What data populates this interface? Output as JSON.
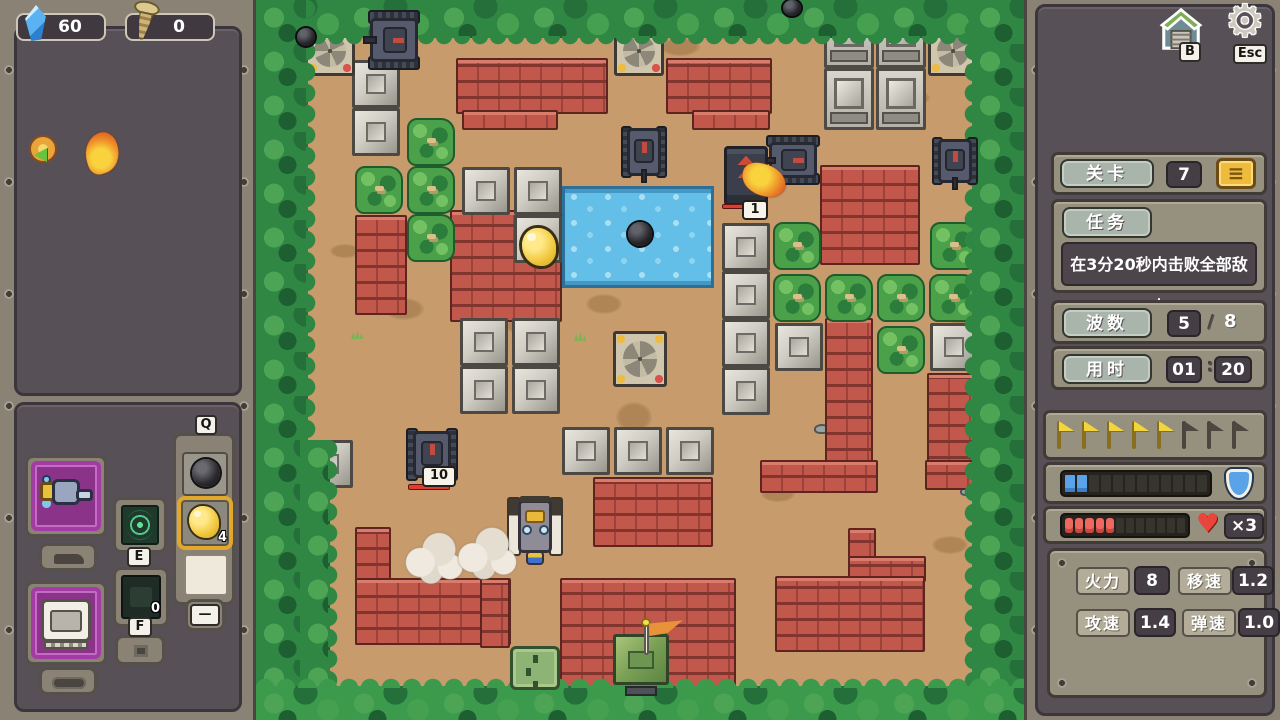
{
  "colors": {
    "accent_gold": "#eebb3d",
    "hp_red": "#ef6860",
    "shield_blue": "#5ba3e8",
    "brick": "#c2574b",
    "panel_dark": "#575056",
    "panel_frame": "#8a8375"
  },
  "left_panel": {
    "resources": [
      {
        "name": "crystal",
        "icon": "crystal-icon",
        "value": "60"
      },
      {
        "name": "screw",
        "icon": "screw-icon",
        "value": "0"
      }
    ],
    "buffs": [
      {
        "name": "return-arrow-buff"
      },
      {
        "name": "flame-buff"
      }
    ],
    "loadout": {
      "q_key": "Q",
      "e_key": "E",
      "f_key": "F",
      "f_count": "0",
      "gold_count": "4",
      "dash": "—",
      "weapon_slot": {
        "name": "cannon"
      },
      "hull_slot": {
        "name": "hull"
      },
      "q_items": [
        {
          "name": "bomb"
        },
        {
          "name": "gold",
          "count": "4",
          "selected": true
        },
        {
          "name": "empty"
        }
      ]
    }
  },
  "right_panel": {
    "garage_key": "B",
    "settings_key": "Esc",
    "level": {
      "label": "关卡",
      "value": "7",
      "button_glyph": "≡"
    },
    "mission": {
      "label": "任务",
      "text": "在3分20秒内击败全部敌人"
    },
    "wave": {
      "label": "波数",
      "current": "5",
      "separator": "/",
      "total": "8"
    },
    "time": {
      "label": "用时",
      "minutes": "01",
      "colon": ":",
      "seconds": "20"
    },
    "wave_flags": {
      "total": 8,
      "lit": 5
    },
    "shield_bar": {
      "segments": 12,
      "filled": 2
    },
    "hp_bar": {
      "segments": 12,
      "filled": 5,
      "lives_label": "×3"
    },
    "stats": [
      {
        "label": "火力",
        "value": "8"
      },
      {
        "label": "移速",
        "value": "1.2"
      },
      {
        "label": "攻速",
        "value": "1.4"
      },
      {
        "label": "弹速",
        "value": "1.0"
      }
    ]
  },
  "map": {
    "entities": [
      {
        "t": "spot",
        "x": 404,
        "y": 38,
        "w": 40,
        "h": 18
      },
      {
        "t": "spot",
        "x": 448,
        "y": 26,
        "w": 30,
        "h": 14
      },
      {
        "t": "spot",
        "x": 128,
        "y": 298,
        "w": 40,
        "h": 22
      },
      {
        "t": "spot",
        "x": 330,
        "y": 294,
        "w": 36,
        "h": 20
      },
      {
        "t": "spot",
        "x": 288,
        "y": 650,
        "w": 40,
        "h": 18
      },
      {
        "t": "spot",
        "x": 505,
        "y": 486,
        "w": 34,
        "h": 16
      },
      {
        "t": "spot",
        "x": 640,
        "y": 90,
        "w": 34,
        "h": 16
      },
      {
        "t": "spot",
        "x": 694,
        "y": 296,
        "w": 30,
        "h": 40
      },
      {
        "t": "spot",
        "x": 404,
        "y": 586,
        "w": 40,
        "h": 20
      },
      {
        "t": "spot",
        "x": 74,
        "y": 244,
        "w": 30,
        "h": 14
      },
      {
        "t": "spot",
        "x": 676,
        "y": 536,
        "w": 36,
        "h": 18
      },
      {
        "t": "spot",
        "x": 310,
        "y": 653,
        "w": 50,
        "h": 22
      },
      {
        "t": "spot",
        "x": 360,
        "y": 402,
        "w": 36,
        "h": 30
      },
      {
        "t": "spot",
        "x": 250,
        "y": 318,
        "w": 30,
        "h": 16
      },
      {
        "t": "pebble",
        "x": 558,
        "y": 424,
        "w": 16,
        "h": 10
      },
      {
        "t": "pebble",
        "x": 704,
        "y": 487,
        "w": 14,
        "h": 9
      },
      {
        "t": "pebble",
        "x": 178,
        "y": 612,
        "w": 18,
        "h": 10
      },
      {
        "t": "pebble",
        "x": 238,
        "y": 604,
        "w": 16,
        "h": 9
      },
      {
        "t": "pebble",
        "x": 310,
        "y": 250,
        "w": 15,
        "h": 9
      },
      {
        "t": "grass",
        "x": 95,
        "y": 330,
        "w": 12,
        "h": 9
      },
      {
        "t": "grass",
        "x": 318,
        "y": 332,
        "w": 12,
        "h": 9
      },
      {
        "t": "grass",
        "x": 60,
        "y": 624,
        "w": 12,
        "h": 9
      },
      {
        "t": "grass",
        "x": 520,
        "y": 610,
        "w": 12,
        "h": 9
      },
      {
        "t": "water",
        "x": 306,
        "y": 186,
        "w": 152,
        "h": 102
      },
      {
        "t": "brick",
        "x": 200,
        "y": 58,
        "w": 152,
        "h": 56
      },
      {
        "t": "brick",
        "x": 206,
        "y": 110,
        "w": 96,
        "h": 20
      },
      {
        "t": "brick",
        "x": 410,
        "y": 58,
        "w": 106,
        "h": 56
      },
      {
        "t": "brick",
        "x": 436,
        "y": 110,
        "w": 78,
        "h": 20
      },
      {
        "t": "brick",
        "x": 99,
        "y": 215,
        "w": 52,
        "h": 100
      },
      {
        "t": "brick",
        "x": 194,
        "y": 210,
        "w": 112,
        "h": 112
      },
      {
        "t": "brick",
        "x": 564,
        "y": 165,
        "w": 100,
        "h": 100
      },
      {
        "t": "brick",
        "x": 569,
        "y": 318,
        "w": 48,
        "h": 148
      },
      {
        "t": "brick",
        "x": 671,
        "y": 373,
        "w": 48,
        "h": 117
      },
      {
        "t": "brick",
        "x": 504,
        "y": 460,
        "w": 118,
        "h": 33
      },
      {
        "t": "brick",
        "x": 669,
        "y": 460,
        "w": 50,
        "h": 30
      },
      {
        "t": "brick",
        "x": 592,
        "y": 528,
        "w": 28,
        "h": 30
      },
      {
        "t": "brick",
        "x": 592,
        "y": 556,
        "w": 78,
        "h": 26
      },
      {
        "t": "brick",
        "x": 519,
        "y": 576,
        "w": 150,
        "h": 76
      },
      {
        "t": "brick",
        "x": 99,
        "y": 527,
        "w": 36,
        "h": 118
      },
      {
        "t": "brick",
        "x": 99,
        "y": 578,
        "w": 156,
        "h": 67
      },
      {
        "t": "brick",
        "x": 224,
        "y": 578,
        "w": 30,
        "h": 70
      },
      {
        "t": "brick",
        "x": 304,
        "y": 578,
        "w": 176,
        "h": 112
      },
      {
        "t": "brick",
        "x": 337,
        "y": 477,
        "w": 120,
        "h": 70
      },
      {
        "t": "bush",
        "x": 151,
        "y": 118,
        "w": 48,
        "h": 48
      },
      {
        "t": "bush",
        "x": 99,
        "y": 166,
        "w": 48,
        "h": 48
      },
      {
        "t": "bush",
        "x": 151,
        "y": 166,
        "w": 48,
        "h": 48
      },
      {
        "t": "bush",
        "x": 151,
        "y": 214,
        "w": 48,
        "h": 48
      },
      {
        "t": "bush",
        "x": 517,
        "y": 222,
        "w": 48,
        "h": 48
      },
      {
        "t": "bush",
        "x": 674,
        "y": 222,
        "w": 48,
        "h": 48
      },
      {
        "t": "bush",
        "x": 517,
        "y": 274,
        "w": 48,
        "h": 48
      },
      {
        "t": "bush",
        "x": 569,
        "y": 274,
        "w": 48,
        "h": 48
      },
      {
        "t": "bush",
        "x": 621,
        "y": 274,
        "w": 48,
        "h": 48
      },
      {
        "t": "bush",
        "x": 673,
        "y": 274,
        "w": 48,
        "h": 48
      },
      {
        "t": "bush",
        "x": 621,
        "y": 326,
        "w": 48,
        "h": 48
      },
      {
        "t": "metal",
        "x": 96,
        "y": 60,
        "w": 48,
        "h": 48
      },
      {
        "t": "metal",
        "x": 96,
        "y": 108,
        "w": 48,
        "h": 48
      },
      {
        "t": "metal",
        "x": 206,
        "y": 167,
        "w": 48,
        "h": 48
      },
      {
        "t": "metal",
        "x": 258,
        "y": 167,
        "w": 48,
        "h": 48
      },
      {
        "t": "metal",
        "x": 258,
        "y": 215,
        "w": 48,
        "h": 48
      },
      {
        "t": "metal",
        "x": 204,
        "y": 318,
        "w": 48,
        "h": 48
      },
      {
        "t": "metal",
        "x": 256,
        "y": 318,
        "w": 48,
        "h": 48
      },
      {
        "t": "metal",
        "x": 204,
        "y": 366,
        "w": 48,
        "h": 48
      },
      {
        "t": "metal",
        "x": 256,
        "y": 366,
        "w": 48,
        "h": 48
      },
      {
        "t": "metal",
        "x": 306,
        "y": 427,
        "w": 48,
        "h": 48
      },
      {
        "t": "metal",
        "x": 358,
        "y": 427,
        "w": 48,
        "h": 48
      },
      {
        "t": "metal",
        "x": 410,
        "y": 427,
        "w": 48,
        "h": 48
      },
      {
        "t": "metal",
        "x": 466,
        "y": 223,
        "w": 48,
        "h": 48
      },
      {
        "t": "metal",
        "x": 466,
        "y": 271,
        "w": 48,
        "h": 48
      },
      {
        "t": "metal",
        "x": 466,
        "y": 319,
        "w": 48,
        "h": 48
      },
      {
        "t": "metal",
        "x": 466,
        "y": 367,
        "w": 48,
        "h": 48
      },
      {
        "t": "metal",
        "x": 519,
        "y": 323,
        "w": 48,
        "h": 48
      },
      {
        "t": "metal",
        "x": 674,
        "y": 323,
        "w": 48,
        "h": 48
      },
      {
        "t": "metal",
        "x": 49,
        "y": 440,
        "w": 48,
        "h": 48
      },
      {
        "t": "bigmetal",
        "x": 568,
        "y": 6,
        "w": 50,
        "h": 62
      },
      {
        "t": "bigmetal",
        "x": 620,
        "y": 6,
        "w": 50,
        "h": 62
      },
      {
        "t": "bigmetal",
        "x": 568,
        "y": 68,
        "w": 50,
        "h": 62
      },
      {
        "t": "bigmetal",
        "x": 620,
        "y": 68,
        "w": 50,
        "h": 62
      },
      {
        "t": "fan",
        "n": "spawner-fan",
        "x": 49,
        "y": 26,
        "w": 50,
        "h": 50
      },
      {
        "t": "fan",
        "n": "spawner-fan",
        "x": 358,
        "y": 26,
        "w": 50,
        "h": 50
      },
      {
        "t": "fan",
        "n": "spawner-fan",
        "x": 672,
        "y": 26,
        "w": 50,
        "h": 50
      },
      {
        "t": "fan",
        "n": "spawner-fan",
        "x": 357,
        "y": 331,
        "w": 54,
        "h": 56
      },
      {
        "t": "trees-top",
        "x": 0,
        "y": 0,
        "w": 768,
        "h": 38
      },
      {
        "t": "trees-left",
        "x": 0,
        "y": 0,
        "w": 52,
        "h": 720
      },
      {
        "t": "trees-left",
        "x": 44,
        "y": 440,
        "w": 30,
        "h": 280
      },
      {
        "t": "trees-right",
        "x": 716,
        "y": 0,
        "w": 52,
        "h": 720
      },
      {
        "t": "trees-bottom",
        "x": 0,
        "y": 686,
        "w": 768,
        "h": 34
      },
      {
        "t": "bomb",
        "n": "mine",
        "x": 41,
        "y": 28,
        "w": 18,
        "h": 18
      },
      {
        "t": "bomb",
        "n": "mine",
        "x": 527,
        "y": 0,
        "w": 18,
        "h": 16
      },
      {
        "t": "bomb",
        "n": "mine",
        "x": 372,
        "y": 222,
        "w": 24,
        "h": 24
      },
      {
        "t": "gold",
        "n": "gold-drop",
        "x": 266,
        "y": 228,
        "w": 34,
        "h": 38
      },
      {
        "t": "hatch",
        "n": "hatch-door",
        "x": 254,
        "y": 646,
        "w": 50,
        "h": 44
      },
      {
        "t": "base",
        "n": "base-flag-block",
        "x": 356,
        "y": 626,
        "w": 58,
        "h": 70
      },
      {
        "t": "tank",
        "n": "enemy-tank",
        "x": 108,
        "y": 12,
        "w": 60,
        "h": 56,
        "dir": "left"
      },
      {
        "t": "tank",
        "n": "enemy-tank",
        "x": 365,
        "y": 124,
        "w": 46,
        "h": 56,
        "dir": "down"
      },
      {
        "t": "tank",
        "n": "enemy-tank",
        "x": 512,
        "y": 131,
        "w": 50,
        "h": 58,
        "dir": "left"
      },
      {
        "t": "tank",
        "n": "enemy-tank",
        "x": 676,
        "y": 135,
        "w": 46,
        "h": 52,
        "dir": "down"
      },
      {
        "t": "tank",
        "n": "enemy-tank",
        "x": 150,
        "y": 426,
        "w": 52,
        "h": 57,
        "dir": "down"
      },
      {
        "t": "elite",
        "n": "elite-enemy",
        "x": 466,
        "y": 146,
        "w": 48,
        "h": 60
      },
      {
        "t": "flame",
        "n": "muzzle-flash",
        "x": 492,
        "y": 158,
        "w": 32,
        "h": 44
      },
      {
        "t": "redbar",
        "n": "enemy-hp-bar",
        "x": 466,
        "y": 204,
        "w": 30,
        "h": 5
      },
      {
        "t": "redbar",
        "n": "enemy-hp-bar",
        "x": 152,
        "y": 484,
        "w": 42,
        "h": 6
      },
      {
        "t": "badge",
        "n": "enemy-hp-badge",
        "x": 486,
        "y": 200,
        "w": 26,
        "h": 20,
        "label": "1"
      },
      {
        "t": "badge",
        "n": "enemy-hp-badge",
        "x": 166,
        "y": 466,
        "w": 34,
        "h": 21,
        "label": "10"
      },
      {
        "t": "player",
        "n": "player-tank",
        "x": 250,
        "y": 493,
        "w": 58,
        "h": 72,
        "dir": "up"
      },
      {
        "t": "smoke",
        "x": 147,
        "y": 530,
        "w": 62,
        "h": 54
      },
      {
        "t": "smoke",
        "x": 199,
        "y": 524,
        "w": 64,
        "h": 56
      }
    ]
  }
}
